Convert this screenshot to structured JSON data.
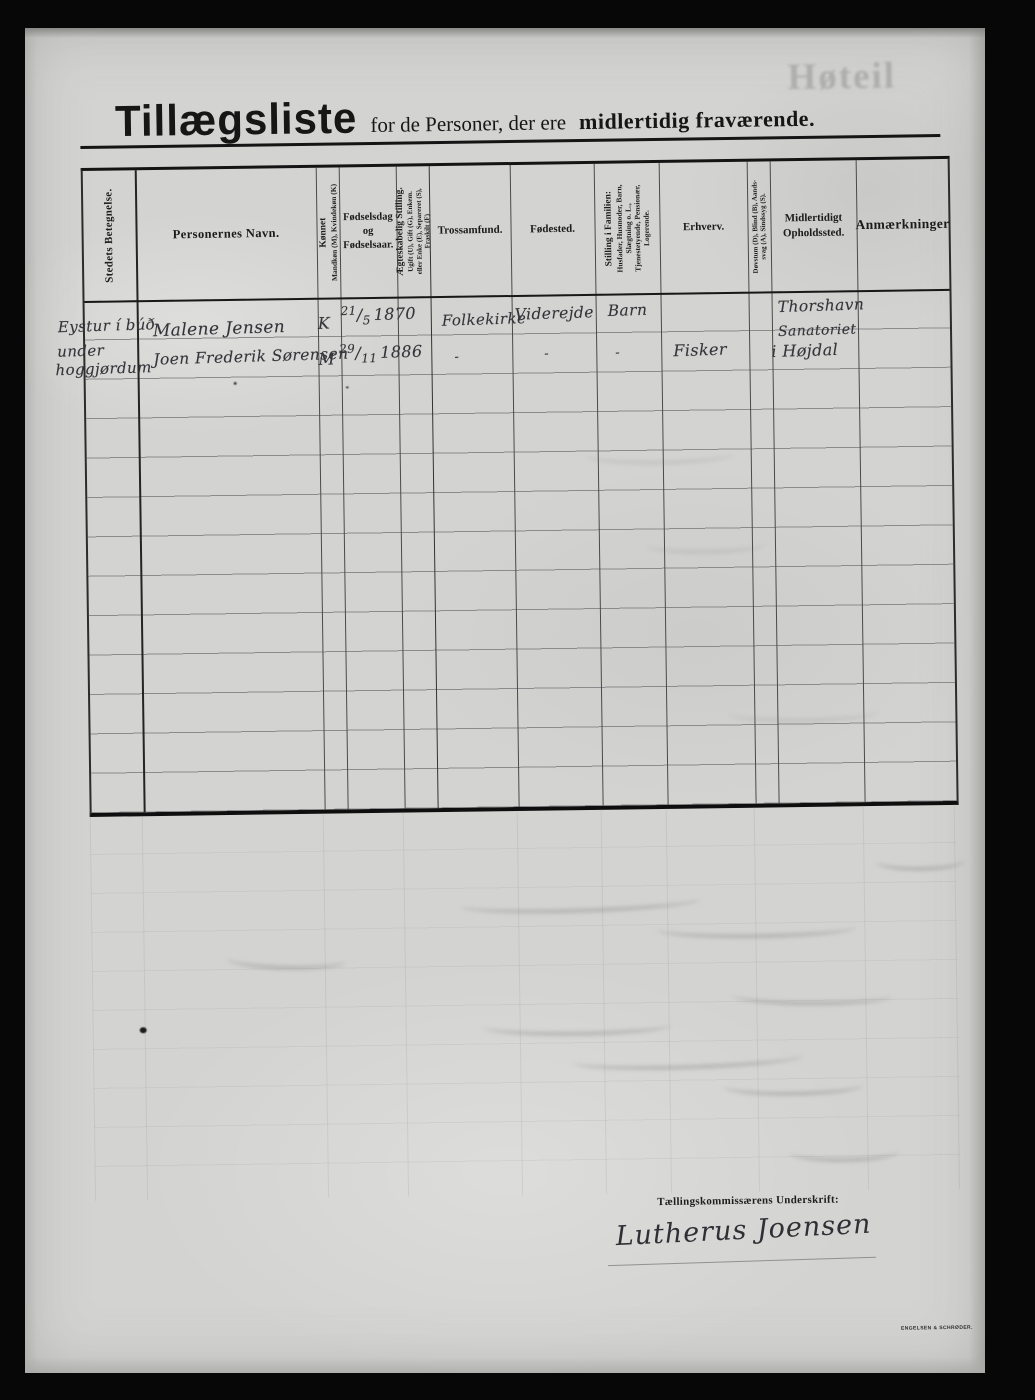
{
  "sheet": {
    "title": {
      "main": "Tillægsliste",
      "mid": "for de Personer, der ere",
      "bold_tail": "midlertidig fraværende."
    },
    "ghost_word": "Høteil",
    "table": {
      "columns": [
        {
          "id": "place",
          "label": "Stedets Betegnelse."
        },
        {
          "id": "name",
          "label": "Personernes Navn."
        },
        {
          "id": "sex",
          "label": "Kønnet\nMandkøn (M), Kvindekøn (K)"
        },
        {
          "id": "birth",
          "label": "Fødselsdag\nog\nFødselsaar."
        },
        {
          "id": "marital",
          "label": "Ægteskabelig Stilling.\nUgift (U), Gift (G), Enkem.\neller Enke (E), Separeret (S),\nFraskilt (F)"
        },
        {
          "id": "faith",
          "label": "Trossamfund."
        },
        {
          "id": "birthplace",
          "label": "Fødested."
        },
        {
          "id": "family",
          "label": "Stilling i Familien:\nHusfader, Husmoder, Barn,\nSlægtning o. L.,\nTjenestetyende, Pensionær,\nLogerende."
        },
        {
          "id": "occupation",
          "label": "Erhverv."
        },
        {
          "id": "disability",
          "label": "Døvstum (D), Blind (B), Aands-\nsvag (A), Sindssyg (S)."
        },
        {
          "id": "residence",
          "label": "Midlertidigt\nOpholdssted."
        },
        {
          "id": "remarks",
          "label": "Anmærkninger"
        }
      ],
      "rows": [
        {
          "place": "Eystur í búð",
          "name": "Malene Jensen",
          "sex": "K",
          "birth_day": "21",
          "birth_sep": "/",
          "birth_month": "5",
          "birth_year": "1870",
          "faith": "Folkekirke",
          "birthplace": "Viderejde",
          "family": "Barn",
          "occupation": "",
          "disability": "",
          "residence": "Thorshavn",
          "remarks": ""
        },
        {
          "place_line1": "under",
          "place_line2": "hoggjørdum",
          "name": "Joen Frederik Sørensen",
          "sex": "M",
          "birth_day": "29",
          "birth_sep": "/",
          "birth_month": "11",
          "birth_year": "1886",
          "faith": "-",
          "birthplace": "-",
          "family": "-",
          "occupation": "Fisker",
          "disability": "",
          "residence_line1": "Sanatoriet",
          "residence_line2": "i Højdal",
          "remarks": ""
        }
      ]
    },
    "footer": {
      "signature_label": "Tællingskommissærens Underskrift:",
      "signature": "Lutherus Joensen",
      "printer_imprint": "ENGELSEN & SCHRØDER."
    }
  }
}
